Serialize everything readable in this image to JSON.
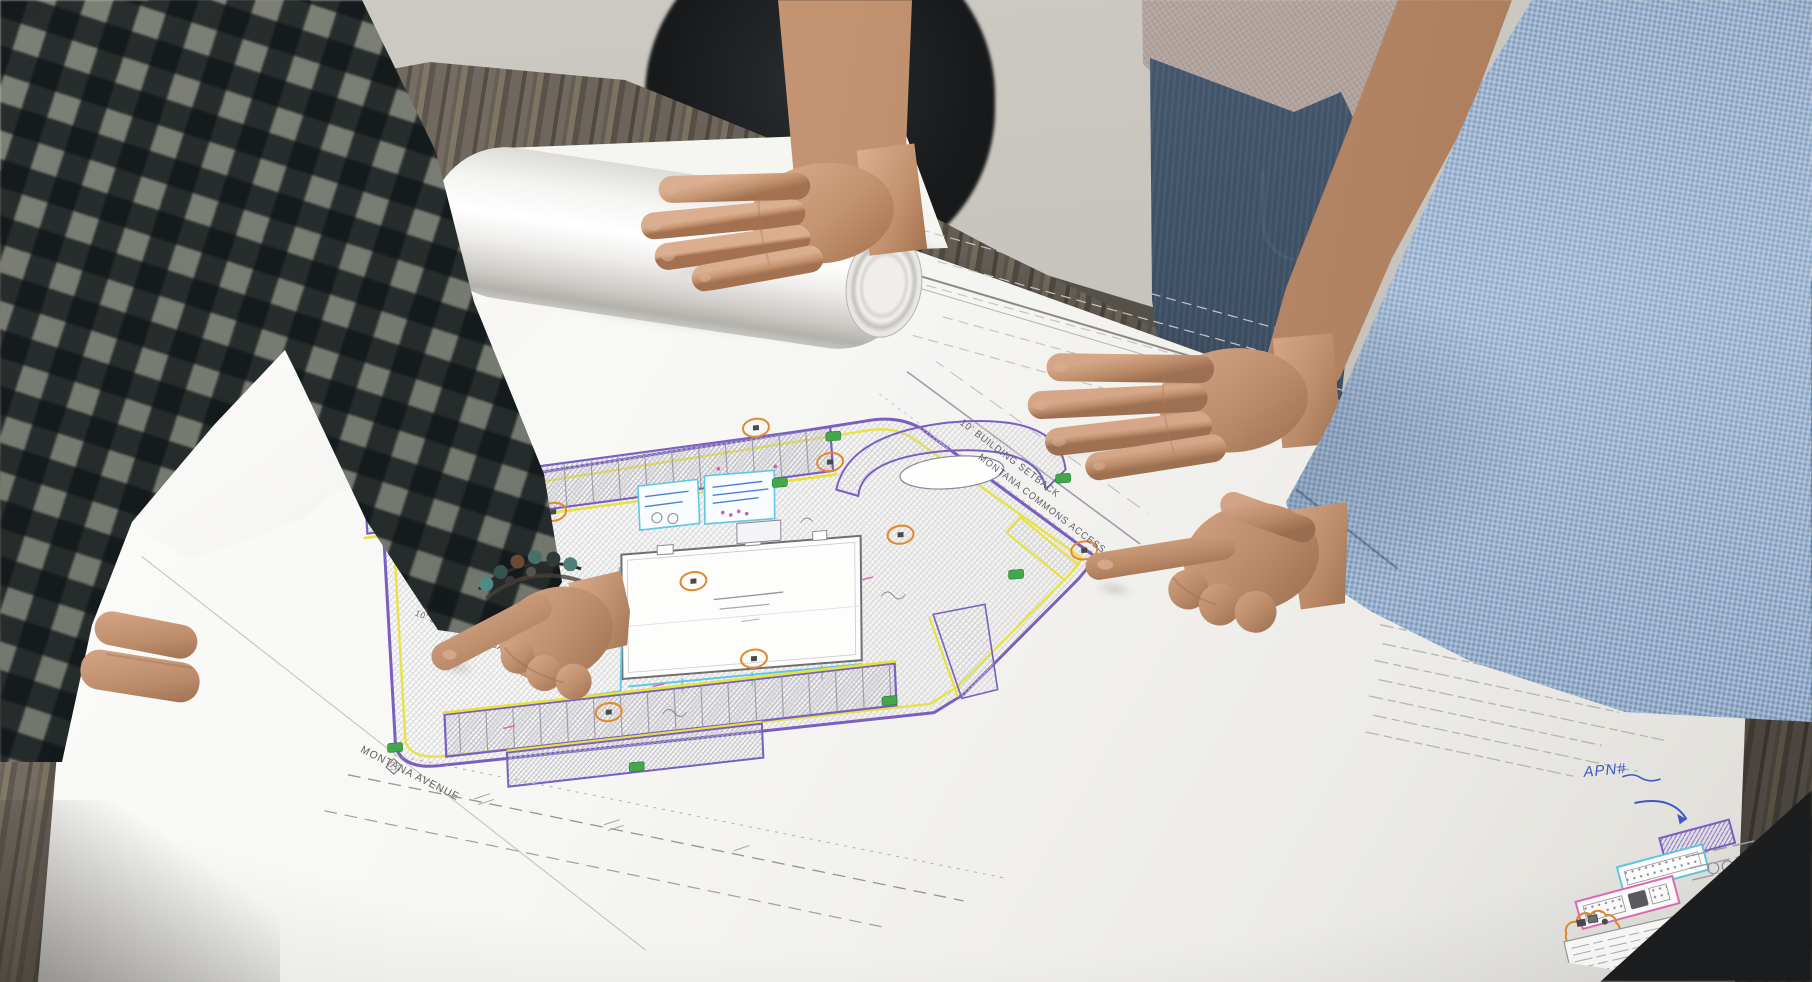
{
  "plan": {
    "labels": {
      "building_setback": "10' BUILDING SETBACK",
      "access_drive": "MONTANA COMMONS ACCESS DRIVE",
      "street": "MONTANA AVENUE"
    },
    "colors": {
      "boundary_purple": "#7a5fc0",
      "curb_yellow": "#e6e23e",
      "utility_cyan": "#5ec7e4",
      "landscape_green": "#43a84b",
      "keynote_orange": "#e2882f",
      "detail_magenta": "#e269b8"
    }
  },
  "legend": {
    "apn_note": "APN#",
    "ink_blue": "#3f58c4"
  }
}
